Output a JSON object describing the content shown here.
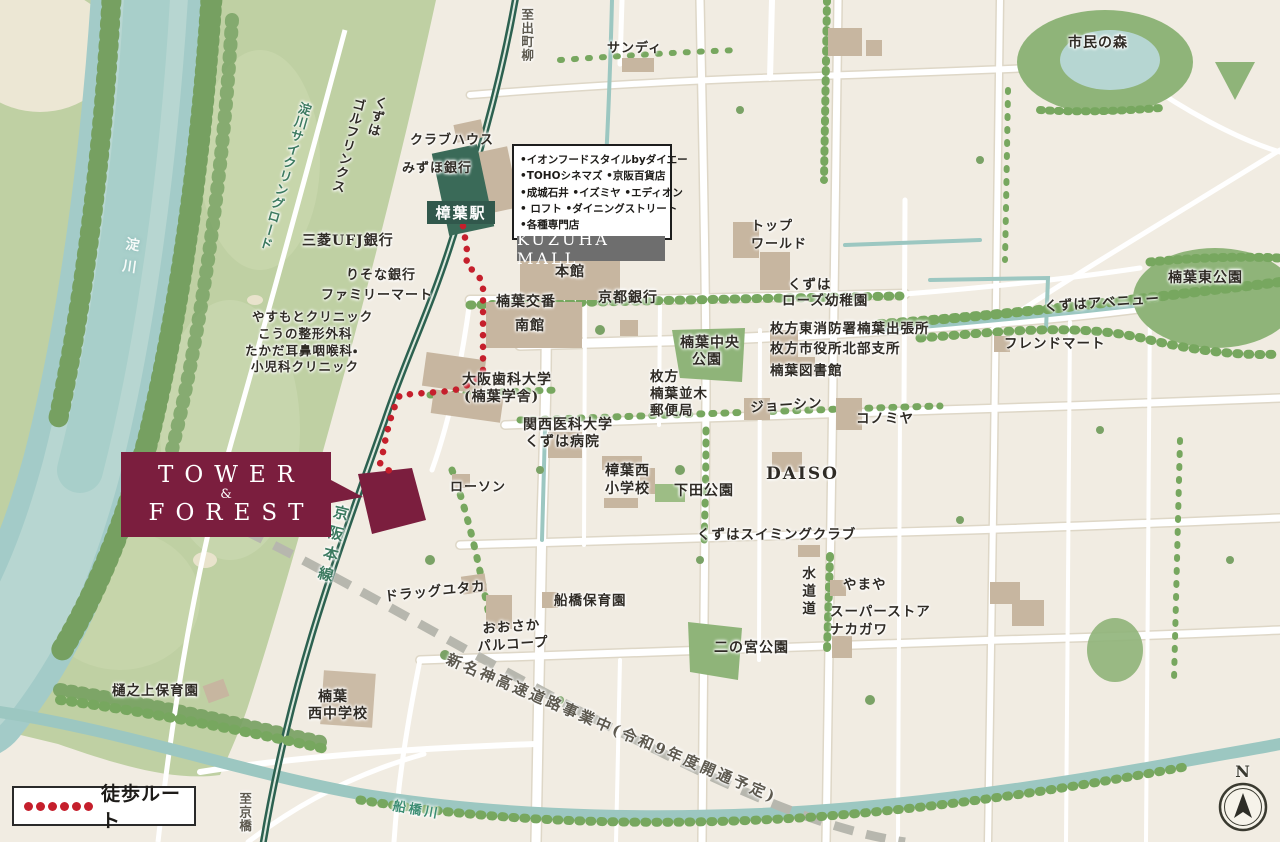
{
  "map_title": "TOWER & FOREST 現地案内図(樟葉駅周辺)",
  "site": {
    "line1": "TOWER",
    "amp": "&",
    "line2": "FOREST"
  },
  "station": {
    "label": "樟葉駅"
  },
  "mall": {
    "name": "KUZUHA MALL",
    "tenants": [
      "•イオンフードスタイルbyダイエー",
      "•TOHOシネマズ •京阪百貨店",
      "•成城石井 •イズミヤ •エディオン",
      "• ロフト •ダイニングストリート",
      "•各種専門店"
    ]
  },
  "legend": {
    "label": "徒歩ルート"
  },
  "compass": {
    "label": "N"
  },
  "colors": {
    "site_maroon": "#7b1e3e",
    "route_red": "#c51f2c",
    "railway_green": "#2c6150",
    "water_teal": "#a3cbc8",
    "mall_gray": "#6e6e6e",
    "station_green": "#31584c",
    "building_tan": "#c7b6a0",
    "forest_green": "#7aa266",
    "background_cream": "#f1ece2"
  },
  "labels": [
    {
      "name": "yodogawa-cycling-road",
      "text": "淀川サイクリングロード",
      "x": 298,
      "y": 100,
      "cls": "v green",
      "rot": 16,
      "fs": 13
    },
    {
      "name": "yodogawa-river",
      "text": "淀川",
      "x": 125,
      "y": 236,
      "cls": "v white",
      "rot": 8,
      "fs": 14,
      "ls": 8
    },
    {
      "name": "to-demachiyanagi",
      "text": "至出町柳",
      "x": 520,
      "y": 8,
      "cls": "v dim",
      "fs": 12.5
    },
    {
      "name": "sandy",
      "text": "サンディ",
      "x": 607,
      "y": 42,
      "fs": 13
    },
    {
      "name": "shimin-no-mori",
      "text": "市民の森",
      "x": 1068,
      "y": 36,
      "fs": 14
    },
    {
      "name": "kuzuha-golf-links-1",
      "text": "くずは",
      "x": 374,
      "y": 94,
      "cls": "v",
      "rot": 14,
      "fs": 13
    },
    {
      "name": "kuzuha-golf-links-2",
      "text": "ゴルフリンクス",
      "x": 352,
      "y": 96,
      "cls": "v",
      "rot": 14,
      "fs": 13
    },
    {
      "name": "clubhouse",
      "text": "クラブハウス",
      "x": 410,
      "y": 134,
      "fs": 13
    },
    {
      "name": "mizuho-bank",
      "text": "みずほ銀行",
      "x": 402,
      "y": 162,
      "fs": 13
    },
    {
      "name": "mitsubishi-ufj-bank",
      "text": "三菱UFJ銀行",
      "x": 302,
      "y": 234,
      "fs": 14
    },
    {
      "name": "risona-bank",
      "text": "りそな銀行",
      "x": 346,
      "y": 269,
      "fs": 13
    },
    {
      "name": "family-mart",
      "text": "ファミリーマート",
      "x": 321,
      "y": 289,
      "fs": 13
    },
    {
      "name": "yasumoto-clinic",
      "text": "やすもとクリニック",
      "x": 252,
      "y": 310,
      "fs": 12.5
    },
    {
      "name": "kono-seikei",
      "text": "こうの整形外科",
      "x": 258,
      "y": 327,
      "fs": 12.5
    },
    {
      "name": "takada-jibika-1",
      "text": "たかだ耳鼻咽喉科・",
      "x": 245,
      "y": 344,
      "fs": 12.5
    },
    {
      "name": "takada-jibika-2",
      "text": "小児科クリニック",
      "x": 251,
      "y": 360,
      "fs": 12.5
    },
    {
      "name": "kuzuha-kouban",
      "text": "楠葉交番",
      "x": 496,
      "y": 295,
      "fs": 14
    },
    {
      "name": "mall-minamikan",
      "text": "南館",
      "x": 515,
      "y": 319,
      "fs": 14
    },
    {
      "name": "mall-honkan",
      "text": "本館",
      "x": 555,
      "y": 265,
      "fs": 14
    },
    {
      "name": "kyoto-bank",
      "text": "京都銀行",
      "x": 598,
      "y": 291,
      "fs": 14
    },
    {
      "name": "osaka-dental-univ-1",
      "text": "大阪歯科大学",
      "x": 462,
      "y": 373,
      "fs": 14
    },
    {
      "name": "osaka-dental-univ-2",
      "text": "(楠葉学舎)",
      "x": 464,
      "y": 390,
      "fs": 14
    },
    {
      "name": "kansai-medical-univ-1",
      "text": "関西医科大学",
      "x": 523,
      "y": 418,
      "fs": 14
    },
    {
      "name": "kansai-medical-univ-2",
      "text": "くずは病院",
      "x": 525,
      "y": 435,
      "fs": 14
    },
    {
      "name": "lawson",
      "text": "ローソン",
      "x": 450,
      "y": 481,
      "fs": 13
    },
    {
      "name": "kuzuha-nishi-elementary-1",
      "text": "樟葉西",
      "x": 605,
      "y": 464,
      "fs": 14
    },
    {
      "name": "kuzuha-nishi-elementary-2",
      "text": "小学校",
      "x": 605,
      "y": 482,
      "fs": 14
    },
    {
      "name": "shimoda-park",
      "text": "下田公園",
      "x": 674,
      "y": 484,
      "fs": 14
    },
    {
      "name": "daiso",
      "text": "DAISO",
      "x": 766,
      "y": 466,
      "cls": "latin",
      "fs": 17
    },
    {
      "name": "kuzuha-swimming-club",
      "text": "くずはスイミングクラブ",
      "x": 697,
      "y": 528,
      "fs": 13.5
    },
    {
      "name": "top-world-1",
      "text": "トップ",
      "x": 751,
      "y": 220,
      "fs": 13
    },
    {
      "name": "top-world-2",
      "text": "ワールド",
      "x": 751,
      "y": 238,
      "fs": 13
    },
    {
      "name": "kuzuha-rose-kindergarten-1",
      "text": "くずは",
      "x": 788,
      "y": 278,
      "fs": 13.5
    },
    {
      "name": "kuzuha-rose-kindergarten-2",
      "text": "ローズ幼稚園",
      "x": 782,
      "y": 294,
      "fs": 13.5
    },
    {
      "name": "hirakata-fire-station",
      "text": "枚方東消防署楠葉出張所",
      "x": 770,
      "y": 322,
      "fs": 13.5
    },
    {
      "name": "hirakata-city-branch",
      "text": "枚方市役所北部支所",
      "x": 770,
      "y": 342,
      "fs": 13.5
    },
    {
      "name": "kuzuha-library",
      "text": "楠葉図書館",
      "x": 770,
      "y": 364,
      "fs": 13.5
    },
    {
      "name": "kuzuha-chuo-park-1",
      "text": "楠葉中央",
      "x": 680,
      "y": 336,
      "fs": 14
    },
    {
      "name": "kuzuha-chuo-park-2",
      "text": "公園",
      "x": 692,
      "y": 353,
      "fs": 14
    },
    {
      "name": "namiki-post-office-1",
      "text": "枚方",
      "x": 650,
      "y": 370,
      "fs": 13.5
    },
    {
      "name": "namiki-post-office-2",
      "text": "楠葉並木",
      "x": 650,
      "y": 387,
      "fs": 13.5
    },
    {
      "name": "namiki-post-office-3",
      "text": "郵便局",
      "x": 650,
      "y": 404,
      "fs": 13.5
    },
    {
      "name": "joshin",
      "text": "ジョーシン",
      "x": 750,
      "y": 401,
      "fs": 13.5,
      "rot": -4
    },
    {
      "name": "konomiya",
      "text": "コノミヤ",
      "x": 856,
      "y": 412,
      "fs": 13.5
    },
    {
      "name": "friend-mart",
      "text": "フレンドマート",
      "x": 1004,
      "y": 337,
      "fs": 13.5
    },
    {
      "name": "kuzuha-avenue",
      "text": "くずはアベニュー",
      "x": 1044,
      "y": 300,
      "fs": 13.5,
      "rot": -4
    },
    {
      "name": "kuzuha-higashi-park",
      "text": "楠葉東公園",
      "x": 1168,
      "y": 271,
      "fs": 14
    },
    {
      "name": "keihan-main-line",
      "text": "京阪本線",
      "x": 334,
      "y": 503,
      "cls": "v green",
      "rot": 14,
      "fs": 15,
      "ls": 6
    },
    {
      "name": "suido-michi",
      "text": "水道道",
      "x": 800,
      "y": 566,
      "cls": "v",
      "fs": 13.5,
      "ls": 4
    },
    {
      "name": "yamaya",
      "text": "やまや",
      "x": 843,
      "y": 578,
      "fs": 13.5
    },
    {
      "name": "super-store-nakagawa-1",
      "text": "スーパーストア",
      "x": 830,
      "y": 605,
      "fs": 13.5
    },
    {
      "name": "super-store-nakagawa-2",
      "text": "ナカガワ",
      "x": 830,
      "y": 623,
      "fs": 13.5
    },
    {
      "name": "ninomiya-park",
      "text": "二の宮公園",
      "x": 714,
      "y": 641,
      "fs": 14
    },
    {
      "name": "drug-yutaka",
      "text": "ドラッグユタカ",
      "x": 384,
      "y": 590,
      "fs": 13.5,
      "rot": -6
    },
    {
      "name": "funabashi-nursery",
      "text": "船橋保育園",
      "x": 554,
      "y": 594,
      "fs": 13.5
    },
    {
      "name": "osaka-palcoop-1",
      "text": "おおさか",
      "x": 482,
      "y": 622,
      "fs": 13.5,
      "rot": -4
    },
    {
      "name": "osaka-palcoop-2",
      "text": "パルコープ",
      "x": 477,
      "y": 640,
      "fs": 13.5,
      "rot": -4
    },
    {
      "name": "hinoue-nursery",
      "text": "樋之上保育園",
      "x": 112,
      "y": 684,
      "fs": 13.5
    },
    {
      "name": "kuzuha-nishi-junior-high-1",
      "text": "楠葉",
      "x": 318,
      "y": 690,
      "fs": 14
    },
    {
      "name": "kuzuha-nishi-junior-high-2",
      "text": "西中学校",
      "x": 308,
      "y": 707,
      "fs": 14
    },
    {
      "name": "to-kyobashi",
      "text": "至京橋",
      "x": 238,
      "y": 792,
      "cls": "v dim",
      "fs": 12.5
    },
    {
      "name": "funabashi-river",
      "text": "船橋川",
      "x": 394,
      "y": 800,
      "cls": "teal",
      "rot": 10,
      "fs": 13,
      "ls": 3
    },
    {
      "name": "shin-meishin-expressway",
      "text": "新名神高速道路事業中(令和9年度開通予定)",
      "x": 450,
      "y": 652,
      "cls": "dim",
      "rot": 23,
      "fs": 15,
      "ls": 3
    }
  ]
}
